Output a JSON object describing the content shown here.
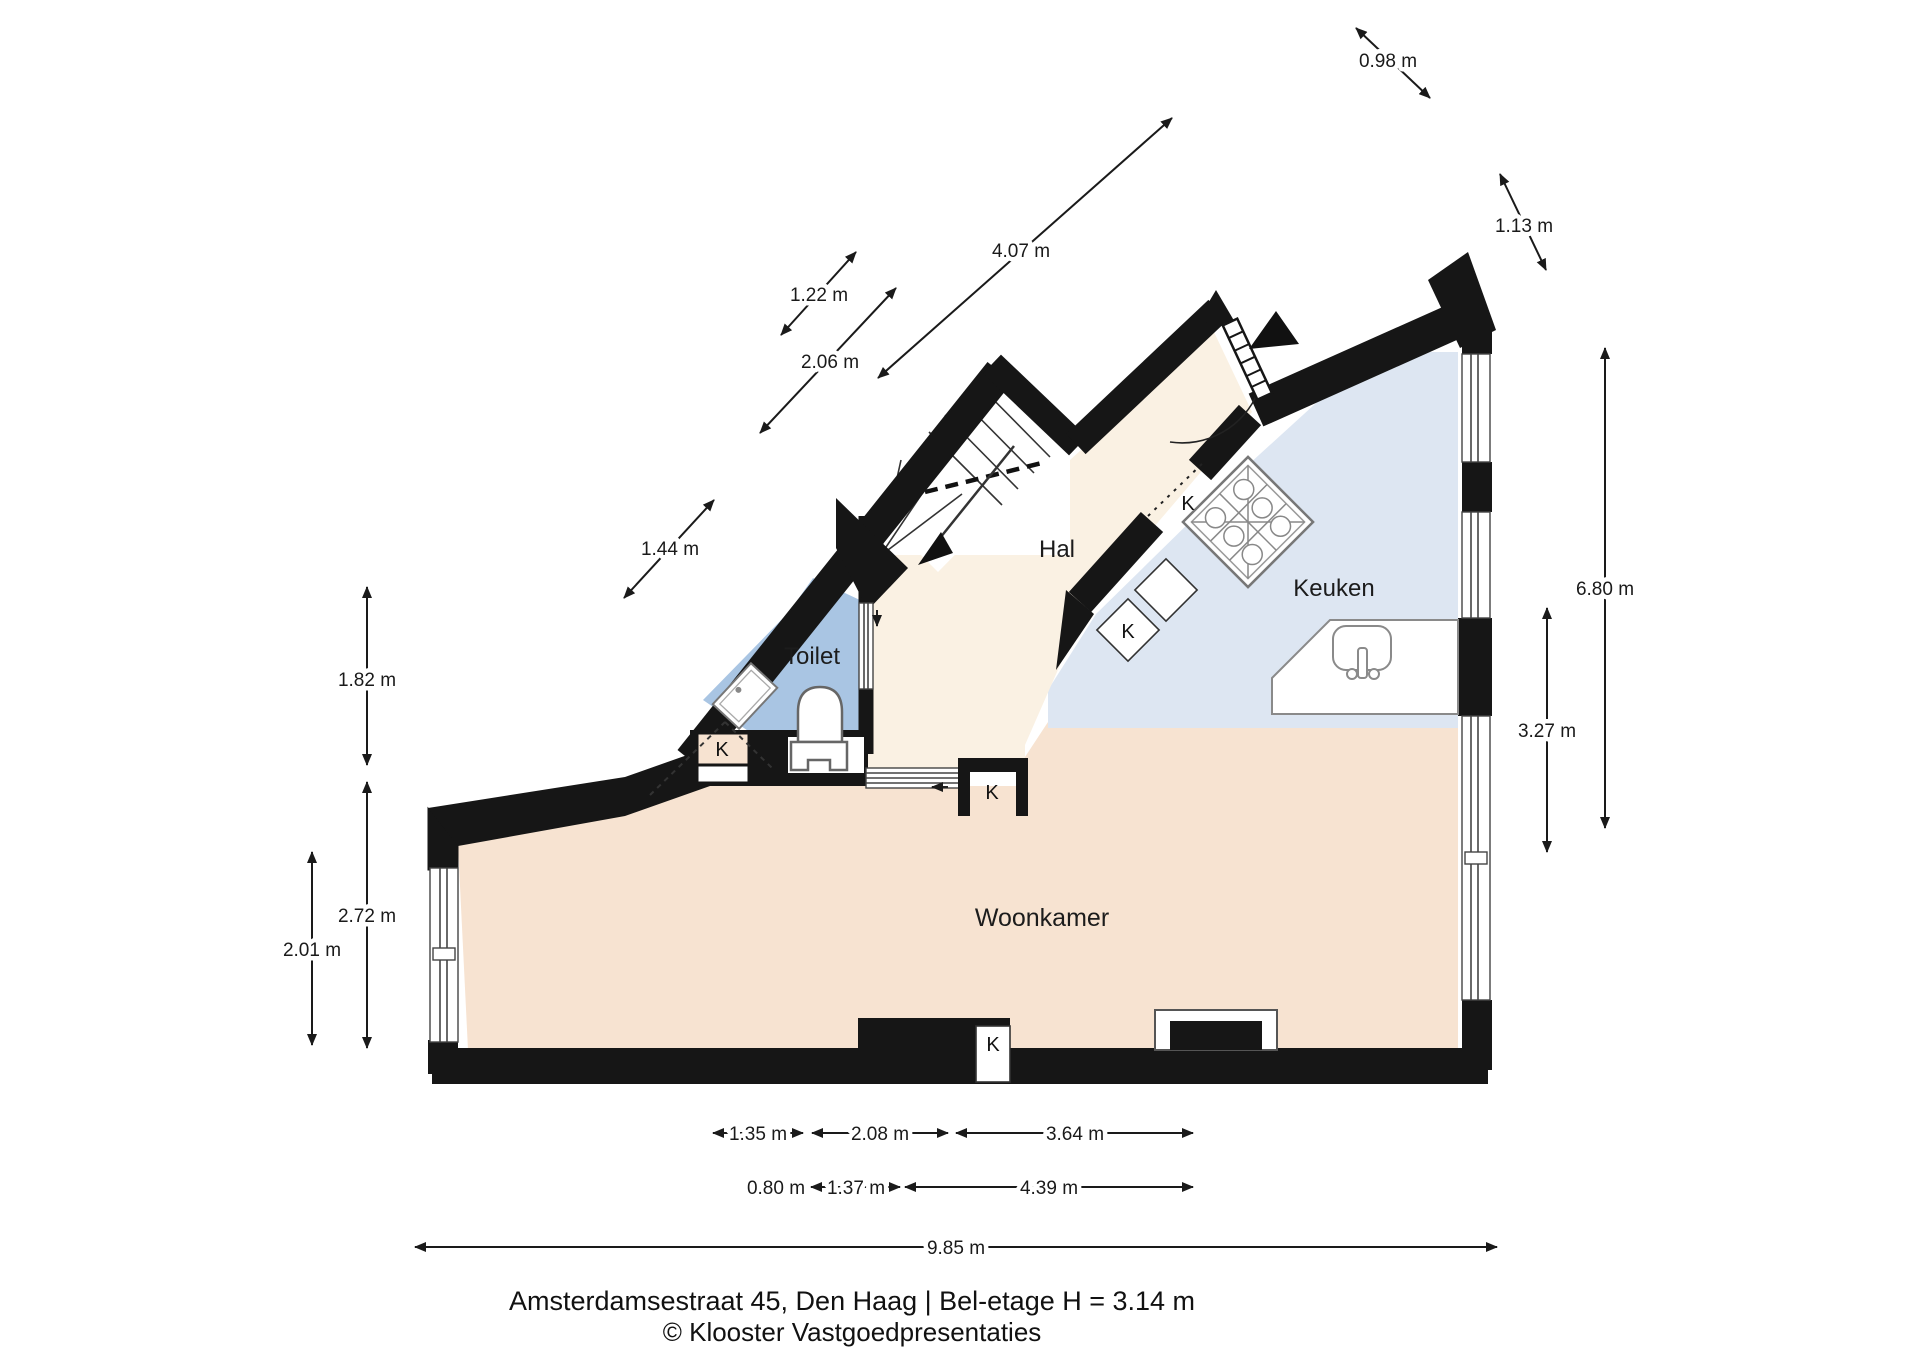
{
  "meta": {
    "address_line": "Amsterdamsestraat 45, Den Haag | Bel-etage H = 3.14 m",
    "credit_line": "© Klooster Vastgoedpresentaties"
  },
  "rooms": [
    {
      "name": "Hal"
    },
    {
      "name": "Keuken"
    },
    {
      "name": "Toilet"
    },
    {
      "name": "Woonkamer"
    }
  ],
  "closet_label": "K",
  "dimensions": [
    {
      "id": "top-right-upper",
      "label": "0.98 m"
    },
    {
      "id": "top-right-lower",
      "label": "1.13 m"
    },
    {
      "id": "diagonal-long",
      "label": "4.07 m"
    },
    {
      "id": "diagonal-upper",
      "label": "1.22 m"
    },
    {
      "id": "diagonal-mid",
      "label": "2.06 m"
    },
    {
      "id": "diagonal-lower",
      "label": "1.44 m"
    },
    {
      "id": "left-upper",
      "label": "1.82 m"
    },
    {
      "id": "left-mid",
      "label": "2.72 m"
    },
    {
      "id": "left-lower",
      "label": "2.01 m"
    },
    {
      "id": "right-outer",
      "label": "6.80 m"
    },
    {
      "id": "right-inner",
      "label": "3.27 m"
    },
    {
      "id": "bottom-row1-left",
      "label": "1.35 m"
    },
    {
      "id": "bottom-row1-mid",
      "label": "2.08 m"
    },
    {
      "id": "bottom-row1-right",
      "label": "3.64 m"
    },
    {
      "id": "bottom-row2-left",
      "label": "0.80 m"
    },
    {
      "id": "bottom-row2-mid",
      "label": "1.37 m"
    },
    {
      "id": "bottom-row2-right",
      "label": "4.39 m"
    },
    {
      "id": "bottom-total",
      "label": "9.85 m"
    }
  ],
  "colors": {
    "wall": "#161616",
    "woonkamer_floor": "#f7e3d1",
    "keuken_floor": "#dde6f2",
    "toilet_floor": "#a9c5e3",
    "hal_floor": "#faf1e3"
  }
}
